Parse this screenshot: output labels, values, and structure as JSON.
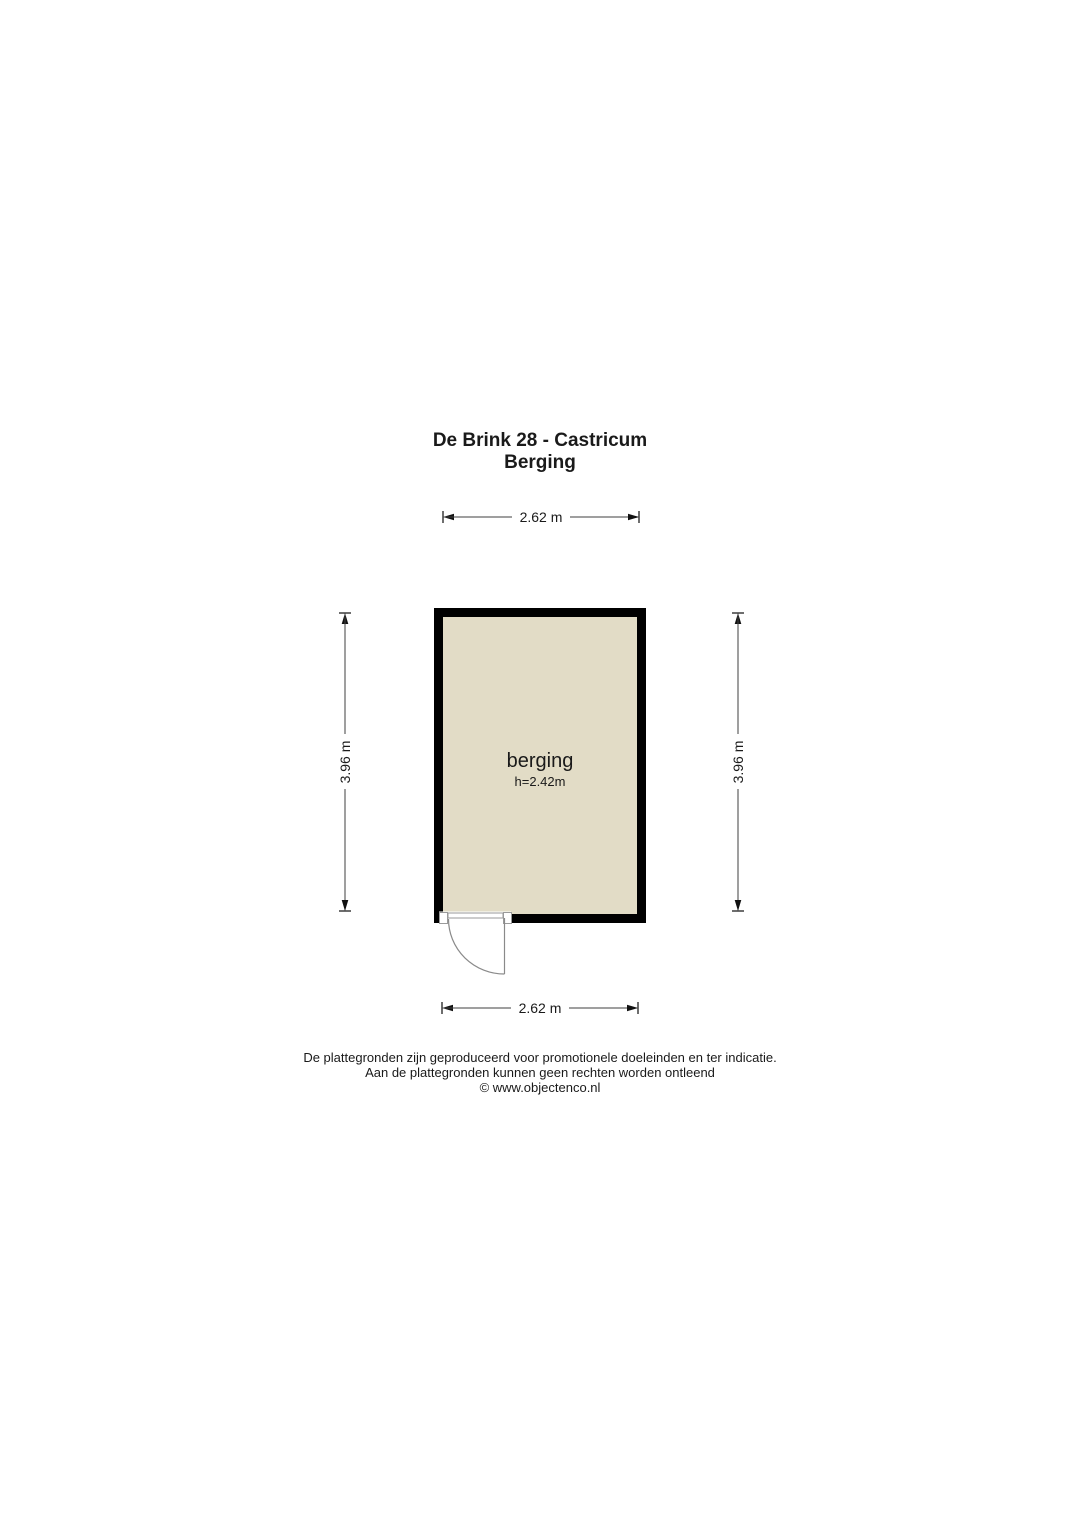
{
  "title": {
    "line1": "De Brink 28 - Castricum",
    "line2": "Berging"
  },
  "room": {
    "name": "berging",
    "ceiling_height": "h=2.42m"
  },
  "dimensions": {
    "top": "2.62 m",
    "bottom": "2.62 m",
    "left": "3.96 m",
    "right": "3.96 m"
  },
  "footer": {
    "line1": "De plattegronden zijn geproduceerd voor promotionele doeleinden en ter indicatie.",
    "line2": "Aan de plattegronden kunnen geen rechten worden ontleend",
    "line3": "© www.objectenco.nl"
  },
  "colors": {
    "wall": "#000000",
    "room_fill": "#e2dcc6",
    "dimension_line": "#3f3f3f",
    "door_line": "#8a8a8a",
    "text": "#1a1a1a",
    "background": "#ffffff"
  }
}
